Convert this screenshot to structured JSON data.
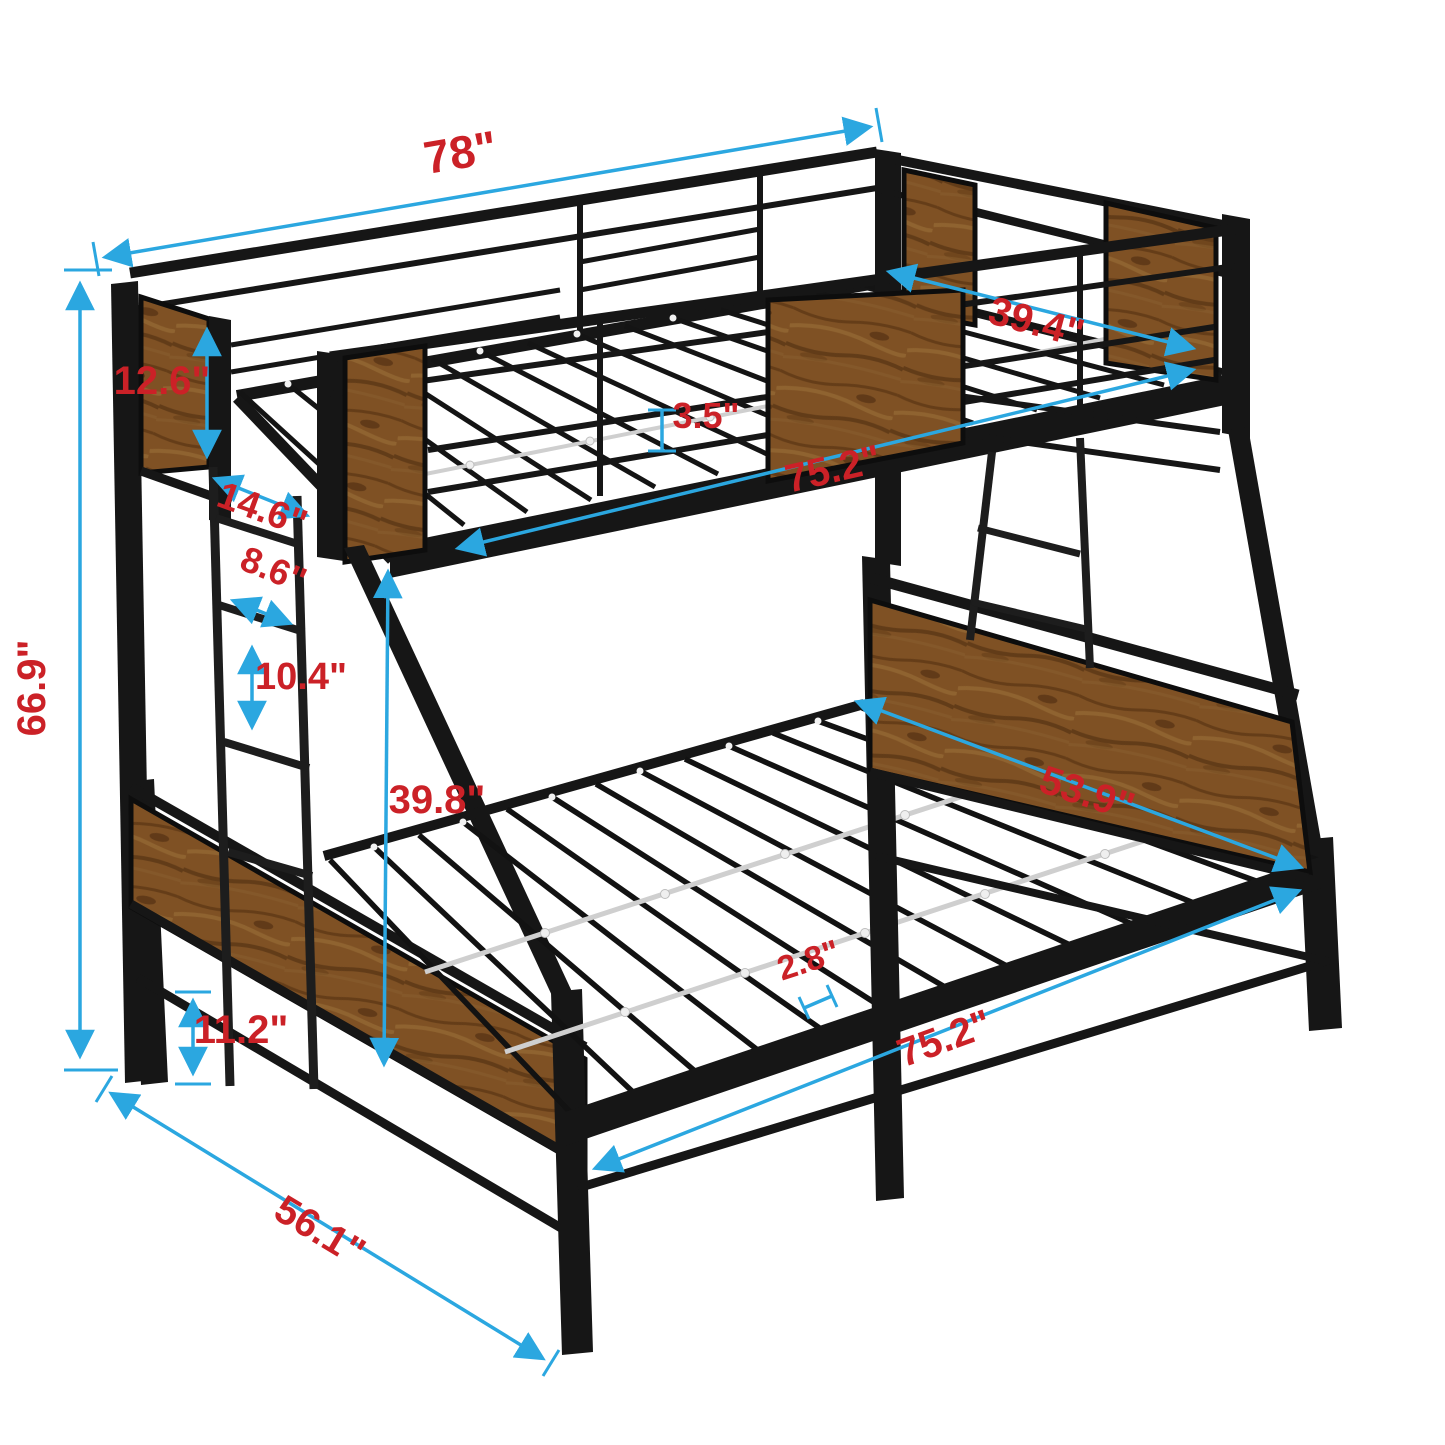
{
  "diagram": {
    "title": "twin-over-full-bunk-bed-dimension-diagram",
    "background_color": "#ffffff",
    "colors": {
      "dimension_line": "#2BA7E0",
      "dimension_label": "#CB2127",
      "metal_frame": "#161616",
      "wood_panel": "#7f5124",
      "slat_support": "#cfcfcf"
    },
    "dimensions": [
      {
        "id": "top-bunk-length",
        "label": "78\""
      },
      {
        "id": "top-bunk-width",
        "label": "39.4\""
      },
      {
        "id": "headboard-panel-height",
        "label": "12.6\""
      },
      {
        "id": "ladder-offset",
        "label": "14.6\""
      },
      {
        "id": "ladder-rung-width",
        "label": "8.6\""
      },
      {
        "id": "ladder-rung-spacing",
        "label": "10.4\""
      },
      {
        "id": "guardrail-gap",
        "label": "3.5\""
      },
      {
        "id": "top-bed-frame-length",
        "label": "75.2\""
      },
      {
        "id": "bunk-clearance-height",
        "label": "39.8\""
      },
      {
        "id": "bottom-bunk-width",
        "label": "53.9\""
      },
      {
        "id": "slat-spacing",
        "label": "2.8\""
      },
      {
        "id": "bottom-bed-frame-length",
        "label": "75.2\""
      },
      {
        "id": "leg-clearance-height",
        "label": "11.2\""
      },
      {
        "id": "overall-height",
        "label": "66.9\""
      },
      {
        "id": "overall-depth",
        "label": "56.1\""
      }
    ]
  }
}
